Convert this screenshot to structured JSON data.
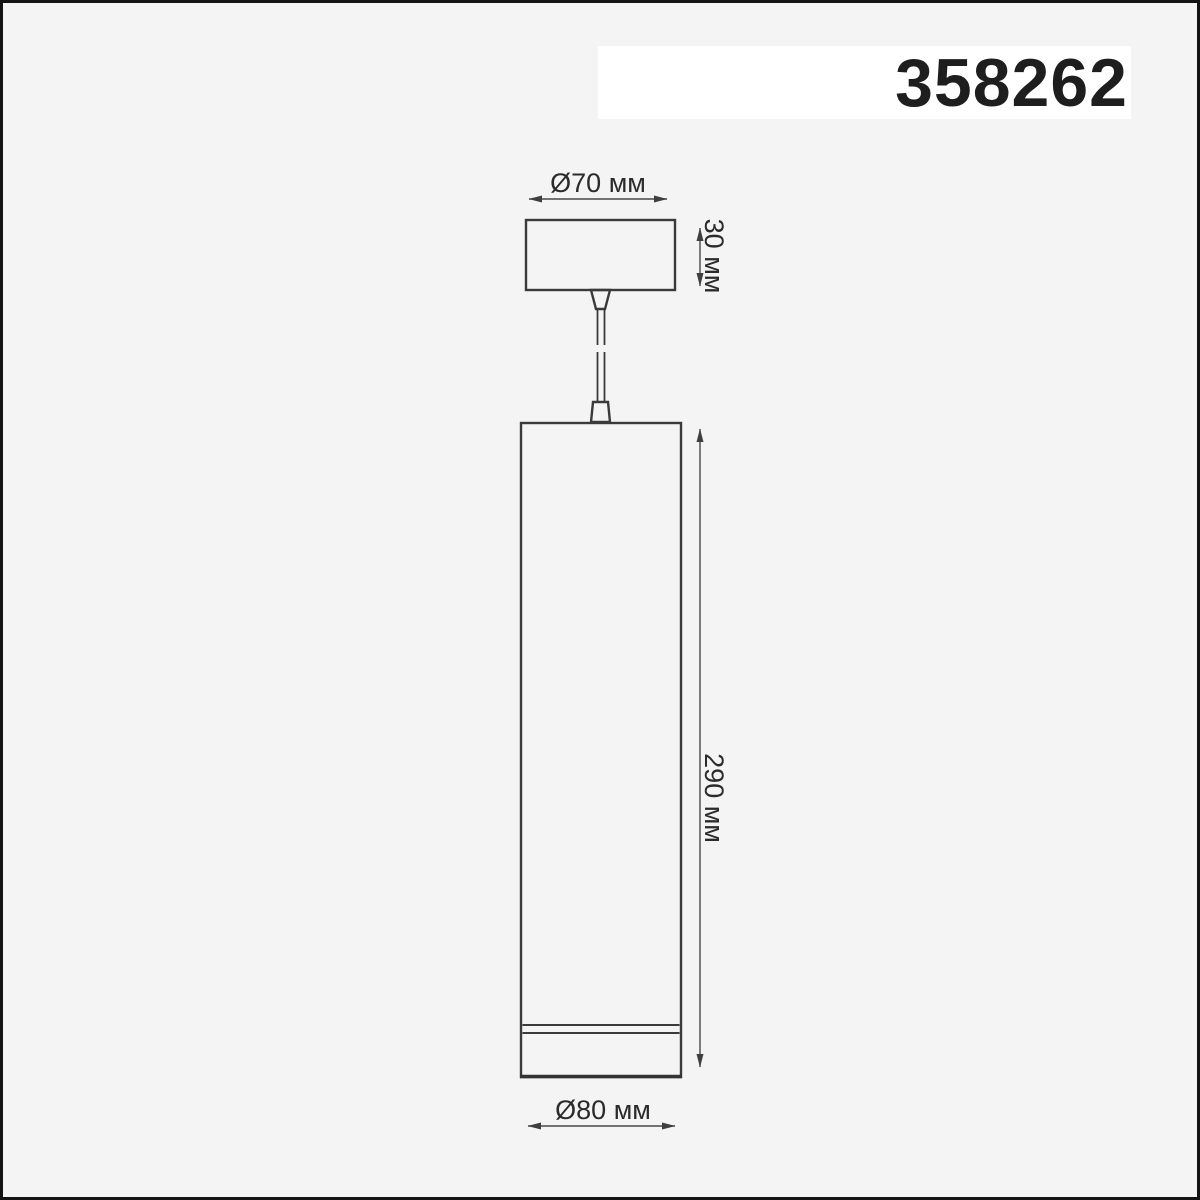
{
  "header": {
    "product_code": "358262"
  },
  "drawing": {
    "type": "pendant-luminaire-dimension-drawing",
    "labels": {
      "canopy_diameter": "Ø70 мм",
      "canopy_height": "30 мм",
      "body_height": "290 мм",
      "body_diameter": "Ø80 мм"
    }
  },
  "colors": {
    "background": "#f4f4f5",
    "panel": "#ffffff",
    "outline_line": "#3a3a3a",
    "dimension_line": "#484848",
    "text": "#2b2b2b",
    "frame_border": "#141414"
  }
}
